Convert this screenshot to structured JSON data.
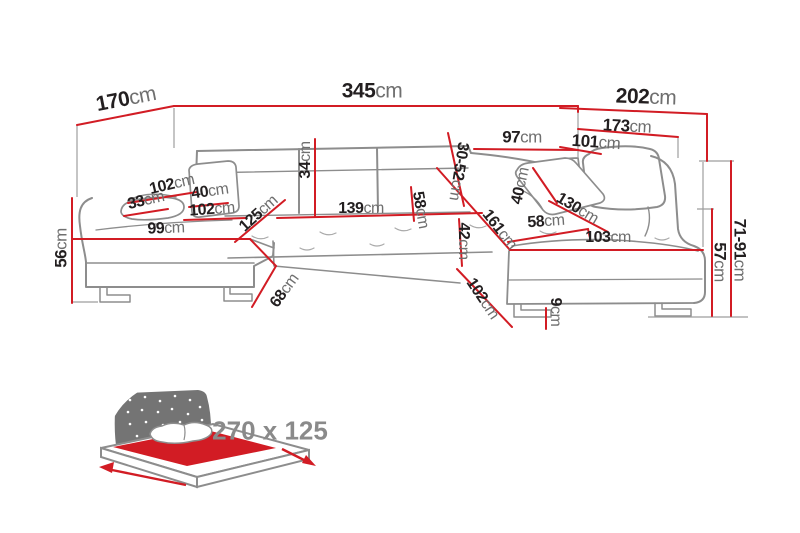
{
  "diagram_type": "corner-sofa-dimension-diagram",
  "colors": {
    "dimension_line": "#d21c24",
    "sofa_outline": "#8d8d8d",
    "value_text": "#231f20",
    "unit_text": "#6f6f6f",
    "bed_icon_gray": "#747474",
    "bed_size_text": "#8a8a8a"
  },
  "measurements": {
    "m170": {
      "value": "170",
      "unit": "cm"
    },
    "m345": {
      "value": "345",
      "unit": "cm"
    },
    "m202": {
      "value": "202",
      "unit": "cm"
    },
    "m173": {
      "value": "173",
      "unit": "cm"
    },
    "m101": {
      "value": "101",
      "unit": "cm"
    },
    "m97": {
      "value": "97",
      "unit": "cm"
    },
    "m34": {
      "value": "34",
      "unit": "cm"
    },
    "m30_52": {
      "value": "30-52",
      "unit": "cm"
    },
    "m102_back": {
      "value": "102",
      "unit": "cm"
    },
    "m33": {
      "value": "33",
      "unit": "cm"
    },
    "m40_left": {
      "value": "40",
      "unit": "cm"
    },
    "m102_seat": {
      "value": "102",
      "unit": "cm"
    },
    "m99": {
      "value": "99",
      "unit": "cm"
    },
    "m125": {
      "value": "125",
      "unit": "cm"
    },
    "m139": {
      "value": "139",
      "unit": "cm"
    },
    "m58_left": {
      "value": "58",
      "unit": "cm"
    },
    "m42": {
      "value": "42",
      "unit": "cm"
    },
    "m161": {
      "value": "161",
      "unit": "cm"
    },
    "m40_right": {
      "value": "40",
      "unit": "cm"
    },
    "m58_right": {
      "value": "58",
      "unit": "cm"
    },
    "m130": {
      "value": "130",
      "unit": "cm"
    },
    "m103": {
      "value": "103",
      "unit": "cm"
    },
    "m56": {
      "value": "56",
      "unit": "cm"
    },
    "m68": {
      "value": "68",
      "unit": "cm"
    },
    "m102_front": {
      "value": "102",
      "unit": "cm"
    },
    "m9": {
      "value": "9",
      "unit": "cm"
    },
    "m57": {
      "value": "57",
      "unit": "cm"
    },
    "m71_91": {
      "value": "71-91",
      "unit": "cm"
    }
  },
  "sleeping_area": {
    "icon": "sleeping-function-bed-icon",
    "label": "270 x 125"
  }
}
